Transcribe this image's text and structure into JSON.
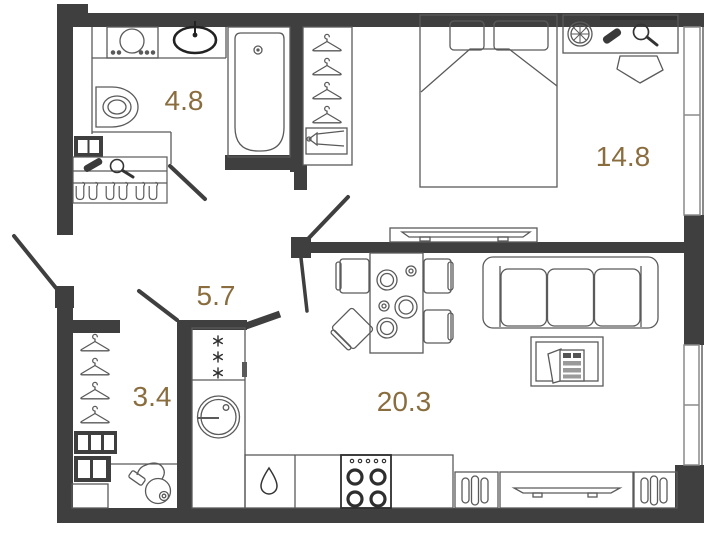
{
  "floorplan": {
    "type": "apartment-floor-plan",
    "rooms": [
      {
        "id": "bathroom",
        "area_label": "4.8"
      },
      {
        "id": "bedroom",
        "area_label": "14.8"
      },
      {
        "id": "hallway",
        "area_label": "5.7"
      },
      {
        "id": "storage-closet",
        "area_label": "3.4"
      },
      {
        "id": "kitchen-living-room",
        "area_label": "20.3"
      }
    ],
    "colors": {
      "wall": "#3f3f3f",
      "furniture_line": "#5a5a5a",
      "dark_detail": "#2e2e2e",
      "area_label": "#8a6d3e",
      "window_frame": "#8a8a8a",
      "background": "#ffffff"
    },
    "icons": [
      "washing-machine-icon",
      "sink-icon",
      "toilet-icon",
      "bathtub-icon",
      "hanger-icon",
      "shoe-box-icon",
      "vent-shaft-icon",
      "brush-icon",
      "hand-mirror-icon",
      "boots-icon",
      "bed-icon",
      "pillow-icon",
      "tv-icon",
      "vanity-mirror-icon",
      "stool-icon",
      "pouf-icon",
      "window-icon",
      "door-swing-icon",
      "fridge-icon",
      "washer-drum-icon",
      "water-drop-icon",
      "stove-icon",
      "radiator-icon",
      "tv-console-icon",
      "sofa-icon",
      "coffee-table-icon",
      "magazines-icon",
      "dining-table-icon",
      "chair-icon",
      "plate-icon",
      "cup-icon",
      "vacuum-cleaner-icon",
      "shoe-rack-icon",
      "snowflake-icon"
    ]
  }
}
